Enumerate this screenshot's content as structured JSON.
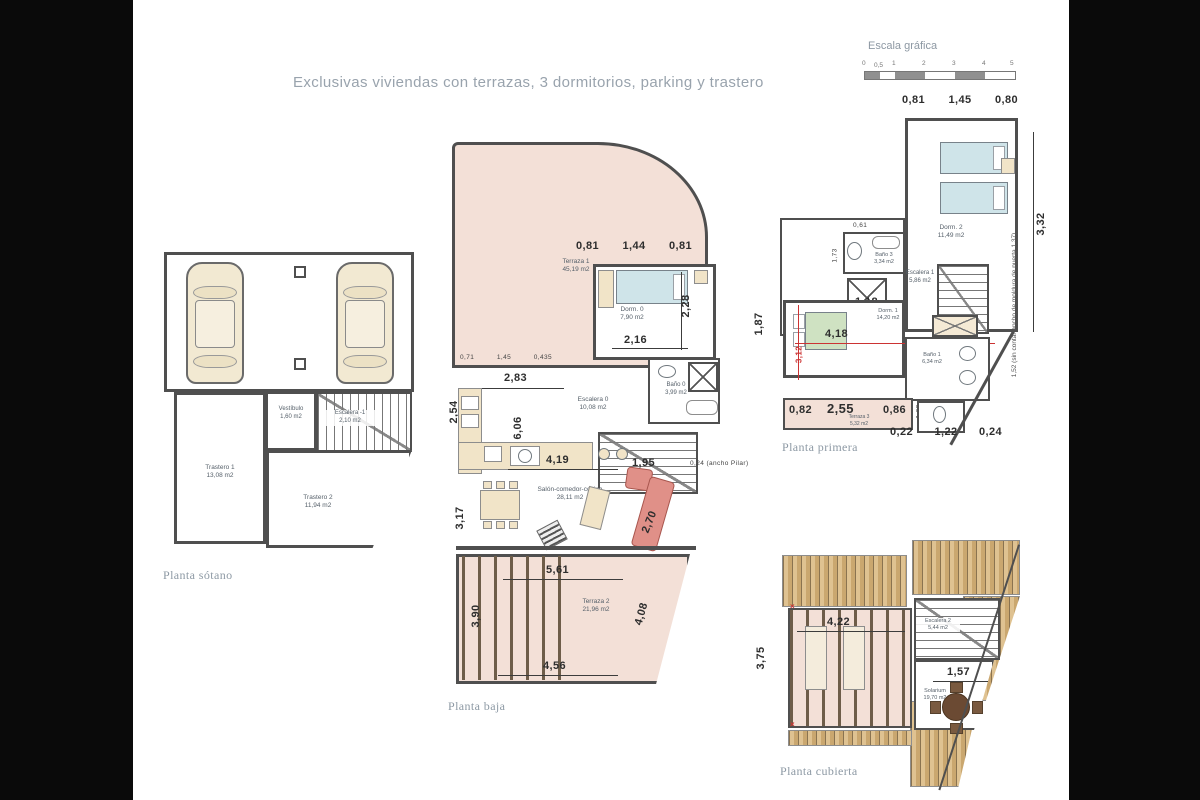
{
  "title": "Exclusivas viviendas con terrazas, 3 dormitorios, parking y trastero",
  "scale": {
    "label": "Escala gráfica",
    "ticks": [
      "0",
      "0,5",
      "1",
      "2",
      "3",
      "4",
      "5"
    ]
  },
  "colors": {
    "terrace_pink": "#f3e0d7",
    "wood_deck": "#caa76f",
    "wall": "#4f4f4f",
    "red_marks": "#cc3333",
    "bed_blue": "#cfe4e9",
    "bed_green": "#cfe2c2",
    "furniture_tan": "#f1e4c8",
    "sofa_red": "#e09088"
  },
  "sotano": {
    "caption": "Planta sótano",
    "trastero1": {
      "name": "Trastero 1",
      "area": "13,08 m2"
    },
    "trastero2": {
      "name": "Trastero 2",
      "area": "11,94 m2"
    },
    "vestibulo": {
      "name": "Vestíbulo",
      "area": "1,60 m2"
    },
    "escalera": {
      "name": "Escalera -1",
      "area": "2,10 m2"
    }
  },
  "baja": {
    "caption": "Planta baja",
    "terraza1": {
      "name": "Terraza 1",
      "area": "45,19 m2"
    },
    "dorm0": {
      "name": "Dorm. 0",
      "area": "7,90 m2"
    },
    "bano0": {
      "name": "Baño 0",
      "area": "3,99 m2"
    },
    "escalera0": {
      "name": "Escalera 0",
      "area": "10,08 m2"
    },
    "salon": {
      "name": "Salón-comedor-cocina",
      "area": "28,11 m2"
    },
    "terraza2": {
      "name": "Terraza 2",
      "area": "21,96 m2"
    },
    "dims": {
      "top": [
        "0,81",
        "1,44",
        "0,81"
      ],
      "small": [
        "0,71",
        "1,45",
        "0,435"
      ],
      "d228": "2,28",
      "d216": "2,16",
      "d283": "2,83",
      "d606": "6,06",
      "d254": "2,54",
      "d419": "4,19",
      "d195": "1,95",
      "d270": "2,70",
      "d317": "3,17",
      "pilar": "0,24 (ancho Pilar)",
      "d561": "5,61",
      "d390": "3,90",
      "d408": "4,08",
      "d456": "4,56"
    }
  },
  "primera": {
    "caption": "Planta primera",
    "dorm2": {
      "name": "Dorm. 2",
      "area": "11,49 m2"
    },
    "bano3": {
      "name": "Baño 3",
      "area": "3,34 m2"
    },
    "escalera1": {
      "name": "Escalera 1",
      "area": "5,86 m2"
    },
    "dorm1": {
      "name": "Dorm. 1",
      "area": "14,20 m2"
    },
    "bano1": {
      "name": "Baño 1",
      "area": "6,34 m2"
    },
    "terraza3": {
      "name": "Terraza 3",
      "area": "5,32 m2"
    },
    "dims": {
      "top": [
        "0,81",
        "1,45",
        "0,80"
      ],
      "bottom": [
        "0,22",
        "1,22",
        "0,24"
      ],
      "d332": "3,32",
      "d061": "0,61",
      "d173": "1,73",
      "d118": "1,18",
      "d418": "4,18",
      "d187": "1,87",
      "d312": "3,12",
      "d082": "0,82",
      "d255": "2,55",
      "d086": "0,86",
      "d108": "1,08",
      "note": "1,52 (sin contar ancho de moldura de puerta 1,37)"
    }
  },
  "cubierta": {
    "caption": "Planta cubierta",
    "escalera2": {
      "name": "Escalera 2",
      "area": "5,44 m2"
    },
    "solarium": {
      "name": "Solarium",
      "area": "19,70 m2"
    },
    "dims": {
      "d422": "4,22",
      "d375": "3,75",
      "d157": "1,57"
    }
  }
}
